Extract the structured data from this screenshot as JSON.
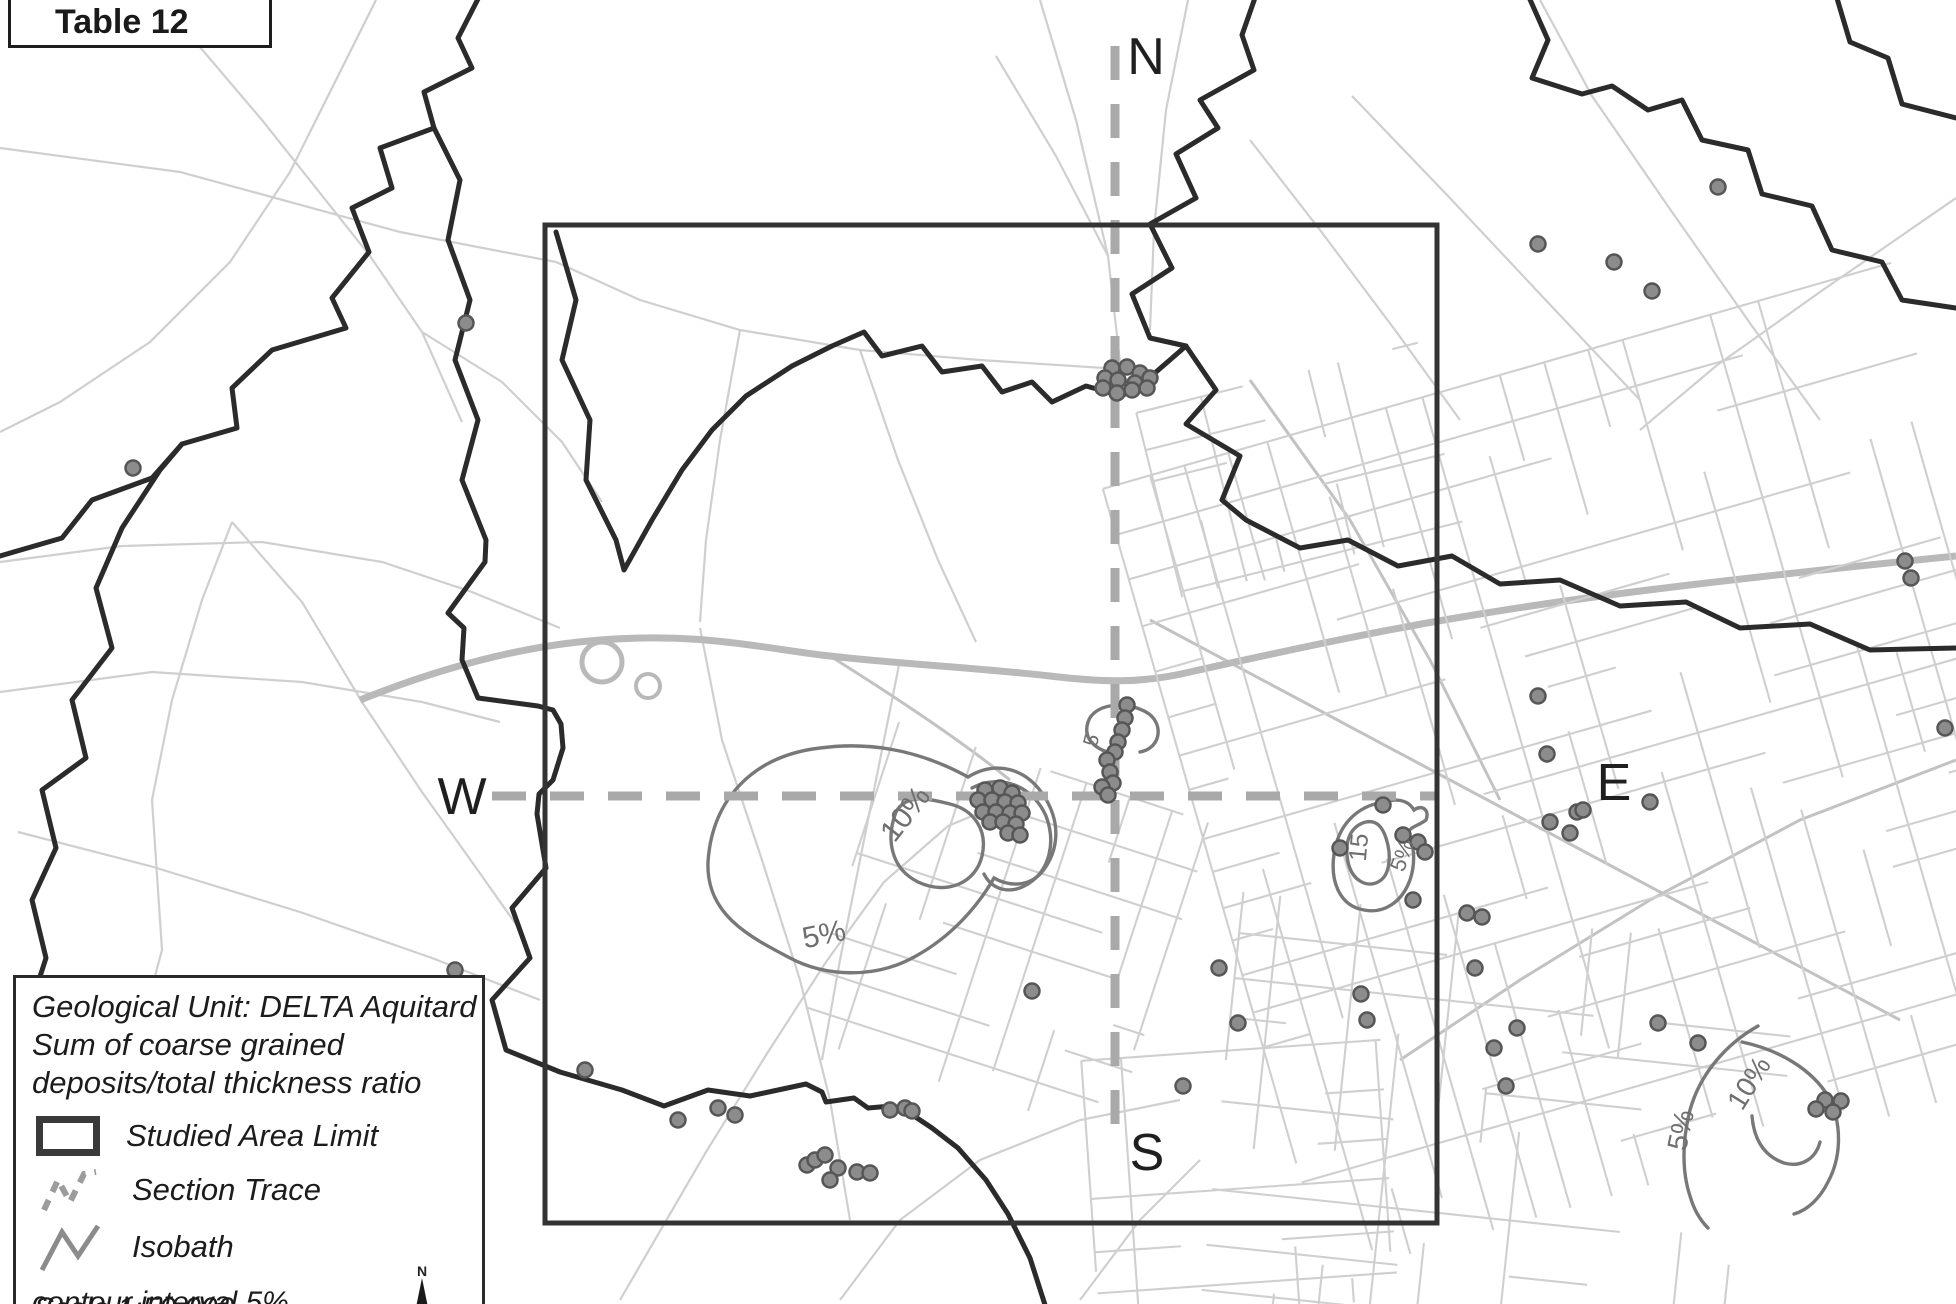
{
  "title_box": {
    "label": "Table 12"
  },
  "section_labels": {
    "north": "N",
    "south": "S",
    "west": "W",
    "east": "E"
  },
  "legend": {
    "title_lines": [
      "Geological Unit: DELTA Aquitard",
      "Sum of coarse grained",
      "deposits/total thickness ratio"
    ],
    "items": [
      {
        "symbol": "studied-area-rect",
        "label": "Studied Area Limit"
      },
      {
        "symbol": "section-trace-dashes",
        "label": "Section Trace"
      },
      {
        "symbol": "isobath-zigzag",
        "label": "Isobath"
      }
    ],
    "note": "contour interval 5%",
    "scale_text": "Scale 1:50,000",
    "compass_label": "N"
  },
  "map": {
    "studied_area": {
      "x": 545,
      "y": 225,
      "w": 892,
      "h": 998
    },
    "section_trace": {
      "vertical": {
        "x": 1115,
        "y1": 46,
        "y2": 1128
      },
      "horizontal": {
        "y": 796,
        "x1": 492,
        "x2": 1437
      },
      "dash": "34 24",
      "width": 9
    },
    "contour_labels": [
      {
        "text": "10%",
        "x": 913,
        "y": 820,
        "rot": -52,
        "size": 30
      },
      {
        "text": "5%",
        "x": 826,
        "y": 944,
        "rot": -12,
        "size": 30
      },
      {
        "text": "5",
        "x": 1098,
        "y": 742,
        "rot": -75,
        "size": 21
      },
      {
        "text": "15",
        "x": 1367,
        "y": 848,
        "rot": -85,
        "size": 25
      },
      {
        "text": "5%",
        "x": 1409,
        "y": 858,
        "rot": -70,
        "size": 22
      },
      {
        "text": "10%",
        "x": 1757,
        "y": 1088,
        "rot": -58,
        "size": 28
      },
      {
        "text": "5%",
        "x": 1690,
        "y": 1132,
        "rot": -78,
        "size": 28
      }
    ],
    "point_style": {
      "radius": 7.5,
      "fill": "#8c8c8c",
      "stroke": "#565656",
      "stroke_width": 2.5
    },
    "colors": {
      "boundary": "#2b2b2b",
      "road": "#cfcfcf",
      "road_medium": "#c2c2c2",
      "highway": "#b9b9b9",
      "contour": "#787878",
      "trace": "#a9a9a9",
      "letters": "#1f1f1f"
    },
    "data_points": [
      [
        466,
        323
      ],
      [
        133,
        468
      ],
      [
        455,
        970
      ],
      [
        585,
        1070
      ],
      [
        1538,
        244
      ],
      [
        1614,
        262
      ],
      [
        1652,
        291
      ],
      [
        1718,
        187
      ],
      [
        1905,
        561
      ],
      [
        1911,
        578
      ],
      [
        1945,
        728
      ],
      [
        1112,
        368
      ],
      [
        1127,
        367
      ],
      [
        1140,
        373
      ],
      [
        1150,
        378
      ],
      [
        1105,
        378
      ],
      [
        1118,
        380
      ],
      [
        1135,
        383
      ],
      [
        1147,
        388
      ],
      [
        1103,
        388
      ],
      [
        1117,
        393
      ],
      [
        1132,
        390
      ],
      [
        1127,
        705
      ],
      [
        1125,
        718
      ],
      [
        1122,
        730
      ],
      [
        1118,
        742
      ],
      [
        1115,
        752
      ],
      [
        1107,
        760
      ],
      [
        1110,
        772
      ],
      [
        1113,
        783
      ],
      [
        1102,
        787
      ],
      [
        1108,
        795
      ],
      [
        985,
        790
      ],
      [
        1000,
        788
      ],
      [
        1012,
        793
      ],
      [
        978,
        800
      ],
      [
        992,
        800
      ],
      [
        1005,
        802
      ],
      [
        1018,
        803
      ],
      [
        983,
        812
      ],
      [
        996,
        812
      ],
      [
        1010,
        813
      ],
      [
        1022,
        813
      ],
      [
        990,
        822
      ],
      [
        1003,
        822
      ],
      [
        1016,
        824
      ],
      [
        1008,
        833
      ],
      [
        1020,
        835
      ],
      [
        1032,
        991
      ],
      [
        1183,
        1086
      ],
      [
        1219,
        968
      ],
      [
        1238,
        1023
      ],
      [
        1361,
        994
      ],
      [
        1367,
        1020
      ],
      [
        1475,
        968
      ],
      [
        1494,
        1048
      ],
      [
        1506,
        1086
      ],
      [
        1517,
        1028
      ],
      [
        1538,
        696
      ],
      [
        1547,
        754
      ],
      [
        1570,
        833
      ],
      [
        1550,
        822
      ],
      [
        1577,
        812
      ],
      [
        1650,
        802
      ],
      [
        1583,
        810
      ],
      [
        1383,
        805
      ],
      [
        1340,
        848
      ],
      [
        1403,
        835
      ],
      [
        1418,
        842
      ],
      [
        1425,
        852
      ],
      [
        1413,
        900
      ],
      [
        1467,
        913
      ],
      [
        1482,
        917
      ],
      [
        1658,
        1023
      ],
      [
        1698,
        1043
      ],
      [
        1825,
        1100
      ],
      [
        1841,
        1101
      ],
      [
        1816,
        1109
      ],
      [
        1833,
        1112
      ],
      [
        678,
        1120
      ],
      [
        718,
        1108
      ],
      [
        735,
        1115
      ],
      [
        807,
        1165
      ],
      [
        815,
        1160
      ],
      [
        825,
        1155
      ],
      [
        838,
        1168
      ],
      [
        830,
        1180
      ],
      [
        857,
        1172
      ],
      [
        870,
        1173
      ],
      [
        890,
        1110
      ],
      [
        905,
        1108
      ],
      [
        912,
        1111
      ]
    ]
  }
}
